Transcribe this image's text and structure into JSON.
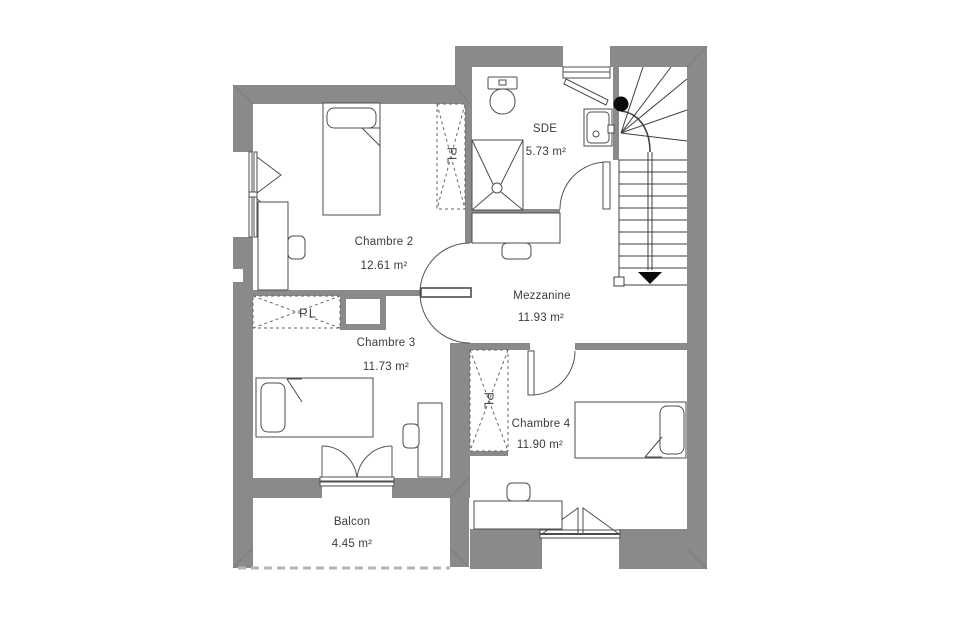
{
  "plan": {
    "type": "floor-plan-etage",
    "rooms": {
      "chambre2": {
        "name": "Chambre 2",
        "area": "12.61 m²"
      },
      "chambre3": {
        "name": "Chambre 3",
        "area": "11.73 m²"
      },
      "chambre4": {
        "name": "Chambre 4",
        "area": "11.90 m²"
      },
      "mezzanine": {
        "name": "Mezzanine",
        "area": "11.93 m²"
      },
      "sde": {
        "name": "SDE",
        "area": "5.73 m²"
      },
      "balcon": {
        "name": "Balcon",
        "area": "4.45 m²"
      }
    },
    "closets": {
      "label": "PL",
      "count": 3
    },
    "stairs": {
      "direction": "down-arrow"
    },
    "colors": {
      "wall": "#8a8a8a",
      "wall_seam": "#7d7d7d",
      "furniture_line": "#4d4d4d",
      "stair_line": "#3f3f3f",
      "text": "#3c3c3c",
      "dashed_edge": "#b5b5b5",
      "background": "#ffffff"
    }
  }
}
